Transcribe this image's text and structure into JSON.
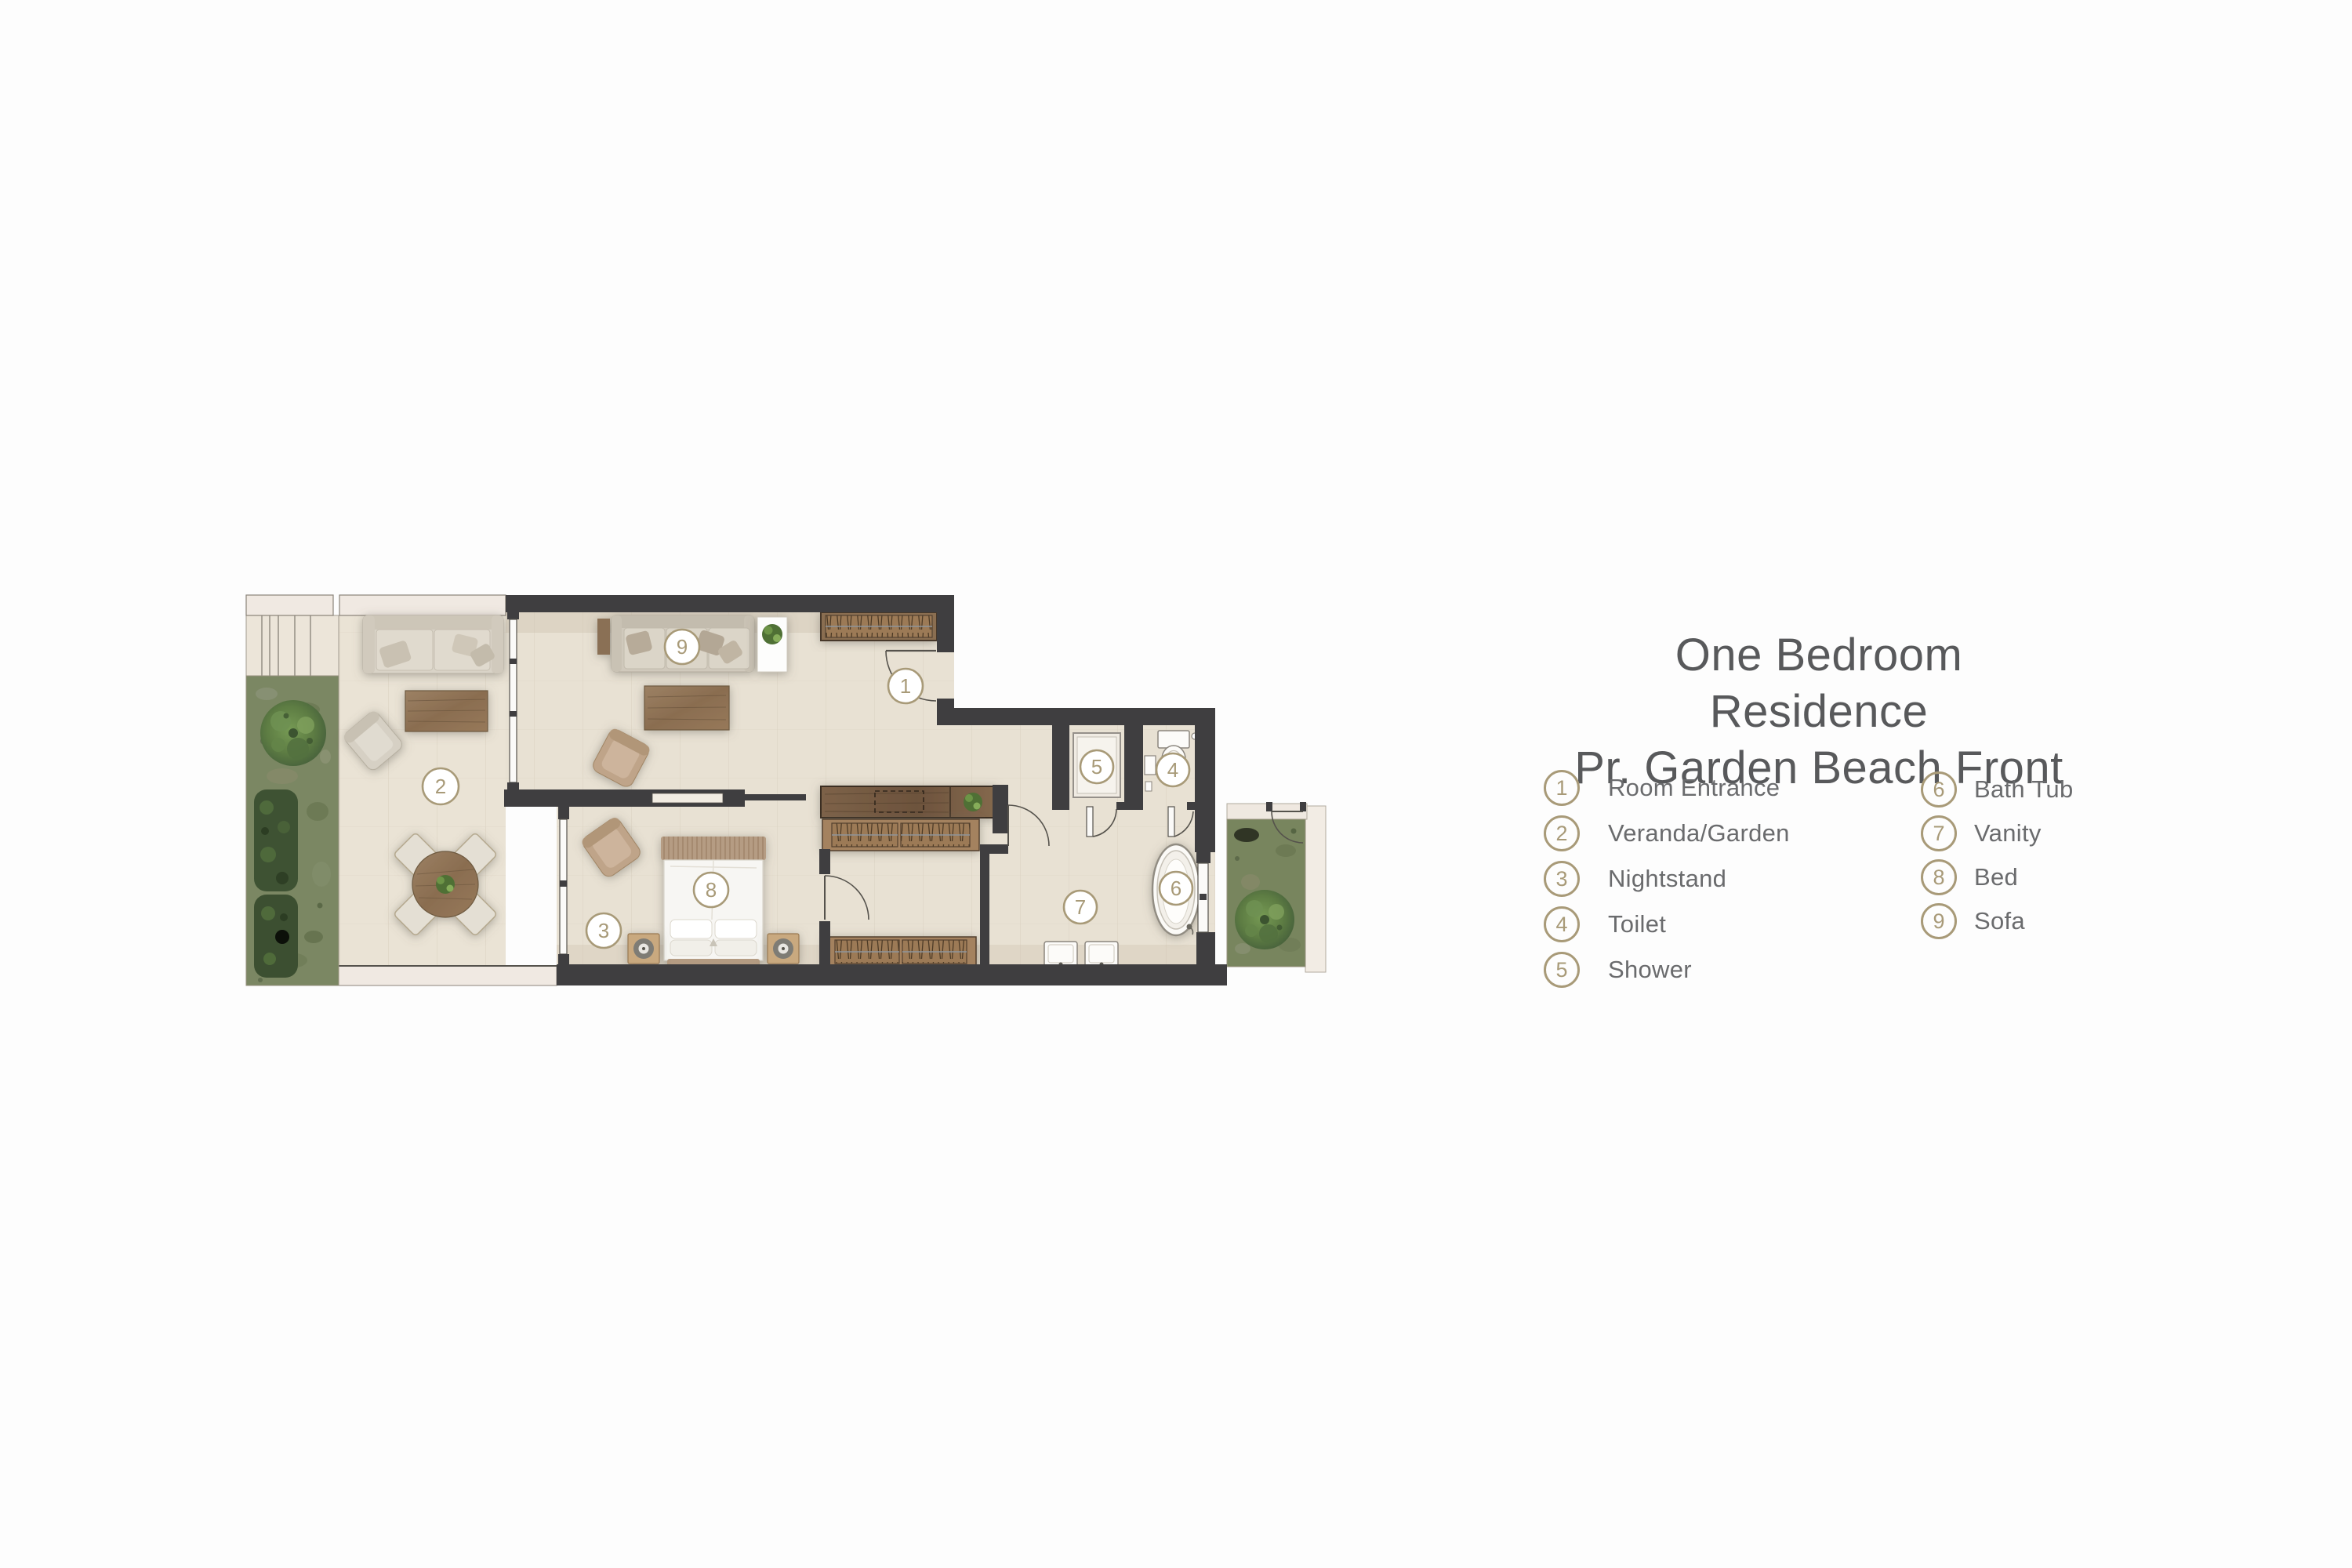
{
  "title": {
    "line1": "One Bedroom Residence",
    "line2": "Pr. Garden Beach Front"
  },
  "legend": {
    "column1": [
      {
        "number": "1",
        "label": "Room Entrance"
      },
      {
        "number": "2",
        "label": "Veranda/Garden"
      },
      {
        "number": "3",
        "label": "Nightstand"
      },
      {
        "number": "4",
        "label": "Toilet"
      },
      {
        "number": "5",
        "label": "Shower"
      }
    ],
    "column2": [
      {
        "number": "6",
        "label": "Bath Tub"
      },
      {
        "number": "7",
        "label": "Vanity"
      },
      {
        "number": "8",
        "label": "Bed"
      },
      {
        "number": "9",
        "label": "Sofa"
      }
    ]
  },
  "plan": {
    "markers": [
      "1",
      "2",
      "3",
      "4",
      "5",
      "6",
      "7",
      "8",
      "9"
    ]
  },
  "colors": {
    "accent_gold": "#a89a78",
    "title_text": "#58595b",
    "legend_text": "#6a6b6d",
    "wall": "#3f3e40",
    "floor": "#e8e1d3",
    "garden_green": "#75845c"
  }
}
